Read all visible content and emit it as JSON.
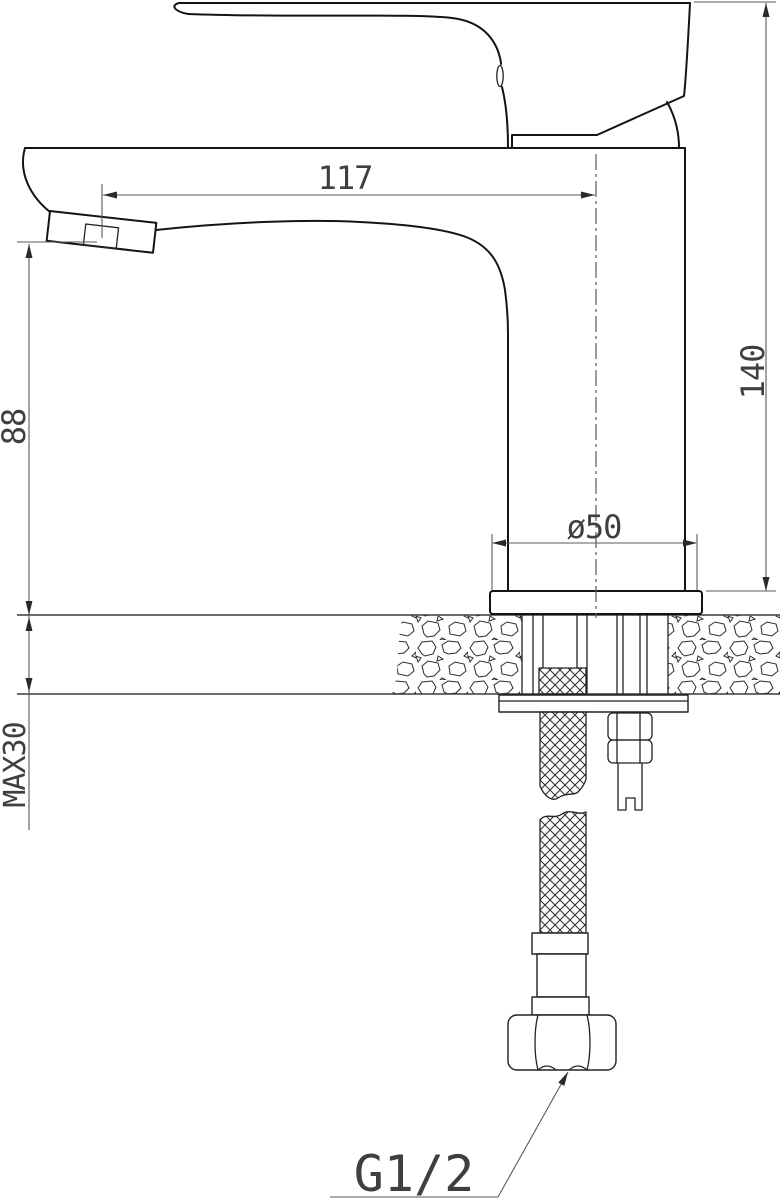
{
  "drawing": {
    "type": "technical-installation-drawing",
    "subject": "single-lever basin mixer tap, side section view with mounting detail",
    "dimensions": {
      "spout_reach_mm": "117",
      "overall_height_mm": "140",
      "spout_height_mm": "88",
      "base_diameter": "ø50",
      "max_mounting_thickness": "MAX30",
      "connection_thread": "G1/2"
    },
    "colors": {
      "line": "#141414",
      "mid": "#3c3c3c",
      "dim": "#5a5a5a",
      "text": "#3f3f3f",
      "background": "#ffffff"
    }
  }
}
